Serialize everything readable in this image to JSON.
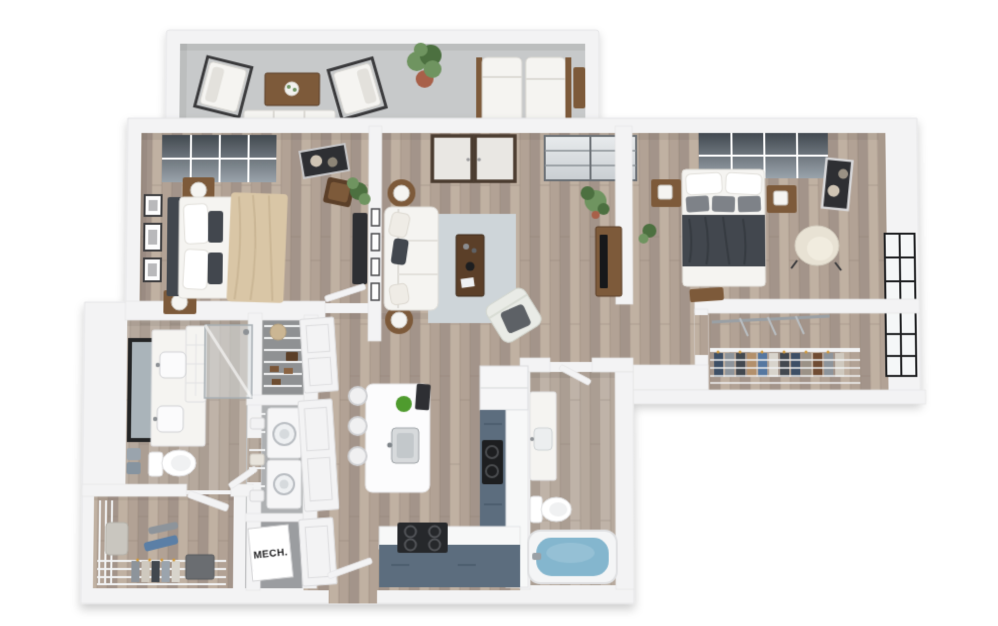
{
  "labels": {
    "mech_closet": "MECH."
  },
  "colors": {
    "wall": "#f3f3f4",
    "wallEdge": "#e4e4e6",
    "floor1": "#b2a295",
    "floor2": "#c0b1a2",
    "floor3": "#a3948a",
    "floorSeam": "#8d7d70",
    "tile1": "#b6a99d",
    "tile2": "#bfb3a8",
    "tile3": "#ab9e93",
    "concrete": "#c7c9ca",
    "slate": "#5c6d7e",
    "counter": "#f7f8f8",
    "rug": "#ced5d9",
    "water": "#84b6ce",
    "charcoal": "#42474e",
    "beige": "#d9c6a6",
    "woodFurn": "#7d5a3a",
    "woodDark": "#5b3f28",
    "plant": "#6f9460",
    "plantDark": "#4c7040",
    "terracotta": "#a86049",
    "furnWhite": "#f5f4f1",
    "cream": "#e8e2d4",
    "artDark": "#2e2f33",
    "mirror": "#aab4ba",
    "wire": "#f2f3f4",
    "appliance": "#f6f6f7",
    "grayFurn": "#6a6d71",
    "textDark": "#1c1c1e",
    "glassDarkTop": "#424950",
    "glassDarkBottom": "#9aa3ab",
    "glassLightTop": "#e8ebed",
    "glassLightBottom": "#c9ced2",
    "frameDark": "#4a3b2f"
  },
  "scene": {
    "description": "3D isometric top-down floor plan rendering of a two-bedroom, two-bathroom apartment with balcony, open kitchen and walk-in closets",
    "rooms": [
      {
        "id": "balcony",
        "name": "balcony",
        "furniture": [
          "outdoor-armchair",
          "outdoor-coffee-table",
          "outdoor-sofa",
          "outdoor-armchair",
          "potted-plant",
          "chaise-lounge",
          "chaise-lounge",
          "side-table"
        ]
      },
      {
        "id": "bedroom-1",
        "name": "bedroom 1",
        "furniture": [
          "bed-with-beige-throw",
          "nightstand-with-lamp",
          "nightstand-with-lamp",
          "gallery-wall-frames",
          "wall-art",
          "wood-chair",
          "potted-plant",
          "media-dresser"
        ]
      },
      {
        "id": "living-room",
        "name": "living room",
        "furniture": [
          "sofa",
          "side-table-with-lamp",
          "side-table-with-lamp",
          "area-rug",
          "coffee-table",
          "accent-chair",
          "tv-console-with-tv",
          "potted-plant",
          "french-doors",
          "sliding-window"
        ]
      },
      {
        "id": "bedroom-2",
        "name": "bedroom 2",
        "furniture": [
          "bed-with-charcoal-duvet",
          "nightstand-with-lamp",
          "nightstand-with-lamp",
          "foot-bench",
          "wall-art",
          "accent-chair",
          "potted-plant"
        ]
      },
      {
        "id": "walk-in-closet-right",
        "name": "walk-in closet",
        "furniture": [
          "wire-shelving",
          "hanging-clothes",
          "closet-rod",
          "window"
        ]
      },
      {
        "id": "bathroom-1",
        "name": "bathroom 1",
        "furniture": [
          "double-vanity",
          "framed-mirror",
          "toilet",
          "towels",
          "glass-shower"
        ]
      },
      {
        "id": "linen-closet",
        "name": "linen closet",
        "furniture": [
          "wire-shelves",
          "hat-box",
          "shoes"
        ]
      },
      {
        "id": "laundry-closet",
        "name": "laundry closet",
        "furniture": [
          "stacked-washer-dryer",
          "wire-shelves-with-baskets"
        ]
      },
      {
        "id": "mech-closet",
        "name": "mechanical closet",
        "furniture": [
          "mechanical-unit"
        ]
      },
      {
        "id": "hallway",
        "name": "hallway",
        "furniture": [
          "paneled-closet-doors",
          "entry-door"
        ]
      },
      {
        "id": "kitchen",
        "name": "kitchen",
        "furniture": [
          "island-with-sink",
          "bar-stools",
          "l-shaped-slate-counter",
          "cooktop",
          "range",
          "fridge"
        ]
      },
      {
        "id": "bathroom-2",
        "name": "bathroom 2",
        "furniture": [
          "vanity-with-sink",
          "toilet",
          "bathtub-with-water"
        ]
      },
      {
        "id": "walk-in-closet-left",
        "name": "entry walk-in closet",
        "furniture": [
          "wire-shelving",
          "hanging-clothes",
          "dresser",
          "hamper"
        ]
      }
    ]
  }
}
